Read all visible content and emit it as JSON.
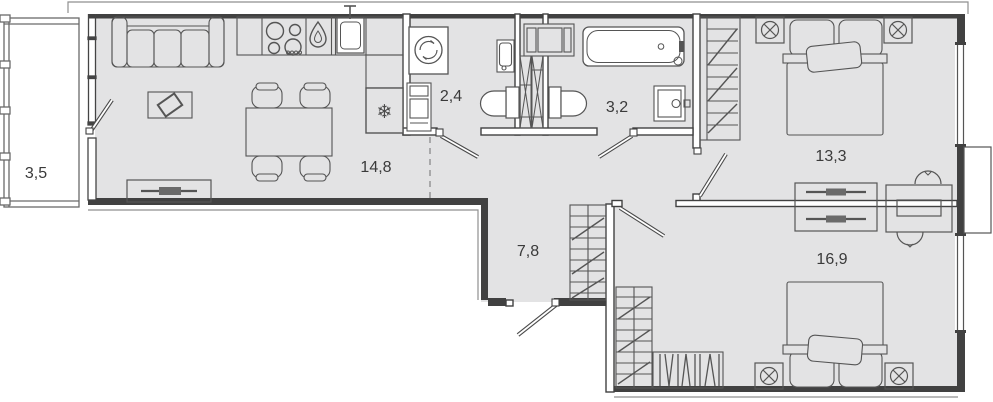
{
  "plan": {
    "type": "apartment-floor-plan",
    "colors": {
      "room_fill": "#e3e3e4",
      "wall": "#414141",
      "thin_outline": "#8f8f8f",
      "furniture_stroke": "#555555",
      "fixture_fill": "#ffffff",
      "label_color": "#3a3a3a"
    },
    "rooms": [
      {
        "name": "balcony",
        "area": "3,5"
      },
      {
        "name": "kitchen-living",
        "area": "14,8"
      },
      {
        "name": "laundry-wc",
        "area": "2,4"
      },
      {
        "name": "bathroom",
        "area": "3,2"
      },
      {
        "name": "bedroom-1",
        "area": "13,3"
      },
      {
        "name": "hallway",
        "area": "7,8"
      },
      {
        "name": "bedroom-2",
        "area": "16,9"
      }
    ]
  }
}
